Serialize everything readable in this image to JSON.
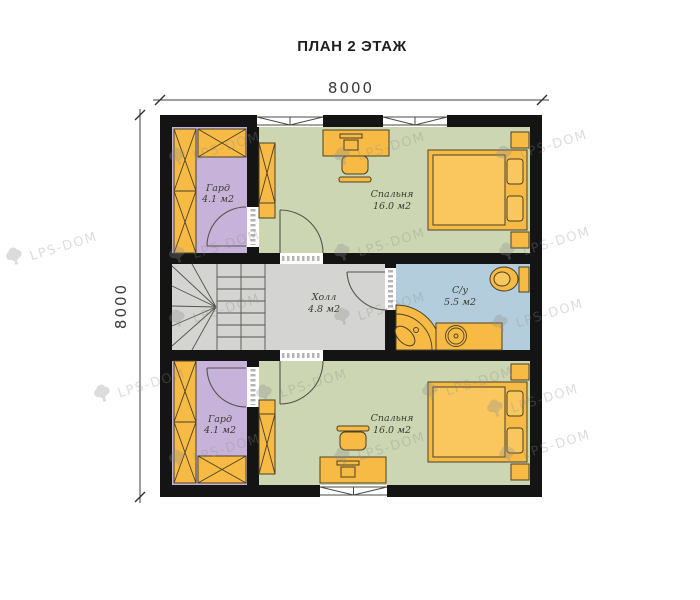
{
  "title": "ПЛАН 2 ЭТАЖ",
  "dimensions": {
    "top": "8000",
    "left": "8000"
  },
  "watermark": {
    "text": "LPS-DOM"
  },
  "colors": {
    "wall": "#141414",
    "bedroom_floor": "#ccd6b3",
    "wardrobe_floor": "#c7b2d9",
    "hall_floor": "#d4d4d2",
    "bath_floor": "#b4cddc",
    "furniture": "#f6ba45",
    "furniture_light": "#f9c75e",
    "furniture_stroke": "#4b4126"
  },
  "rooms": [
    {
      "id": "wardrobe-top",
      "name": "Гард",
      "area": "4.1 м2"
    },
    {
      "id": "bedroom-top",
      "name": "Спальня",
      "area": "16.0 м2"
    },
    {
      "id": "hall",
      "name": "Холл",
      "area": "4.8 м2"
    },
    {
      "id": "bathroom",
      "name": "С/у",
      "area": "5.5 м2"
    },
    {
      "id": "wardrobe-bottom",
      "name": "Гард",
      "area": "4.1 м2"
    },
    {
      "id": "bedroom-bottom",
      "name": "Спальня",
      "area": "16.0 м2"
    }
  ]
}
